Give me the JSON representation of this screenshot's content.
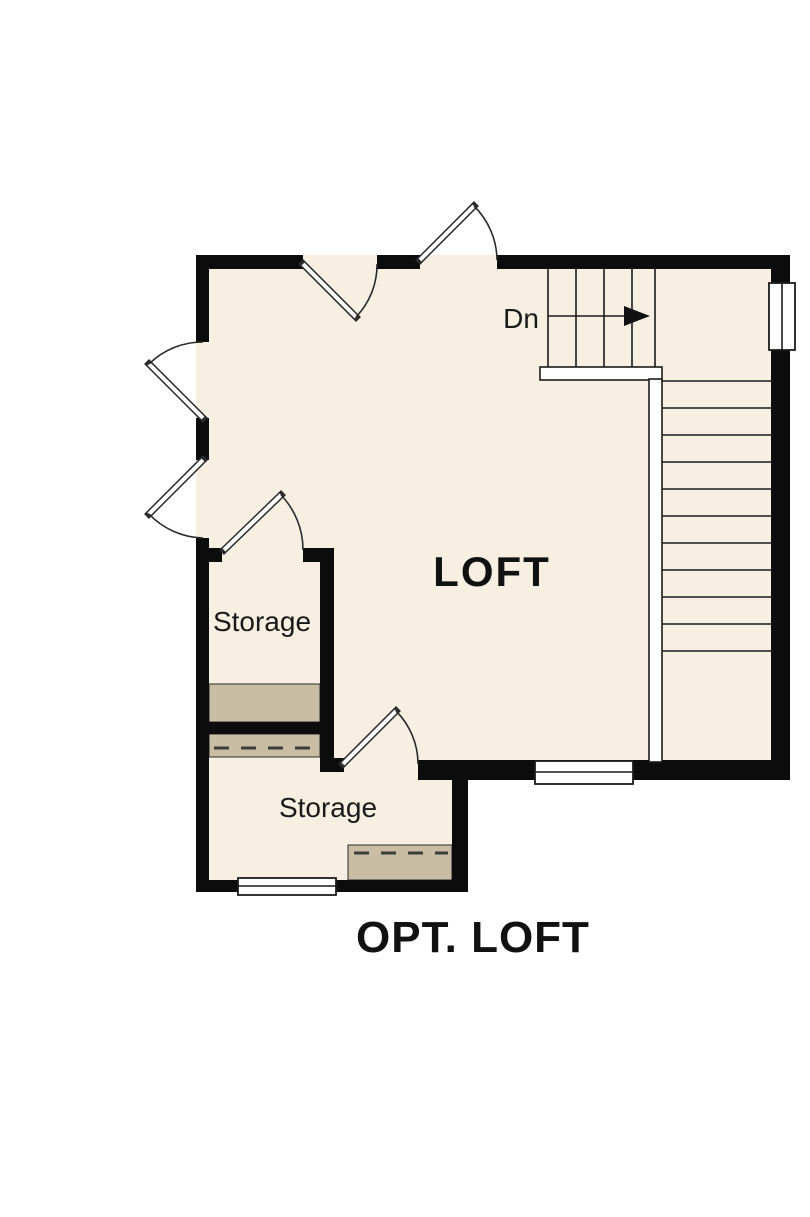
{
  "title": "OPT. LOFT",
  "rooms": {
    "loft": {
      "label": "LOFT"
    },
    "storage_upper": {
      "label": "Storage"
    },
    "storage_lower": {
      "label": "Storage"
    }
  },
  "stairs": {
    "down_label": "Dn",
    "upper_flight_treads": 5,
    "lower_flight_treads": 11,
    "direction": "arrow points right then down along right wall"
  },
  "colors": {
    "wall": "#0c0c0c",
    "floor": "#f6efe2",
    "shelf": "#c9bda4",
    "paper": "#ffffff",
    "line": "#1c1c1c"
  }
}
